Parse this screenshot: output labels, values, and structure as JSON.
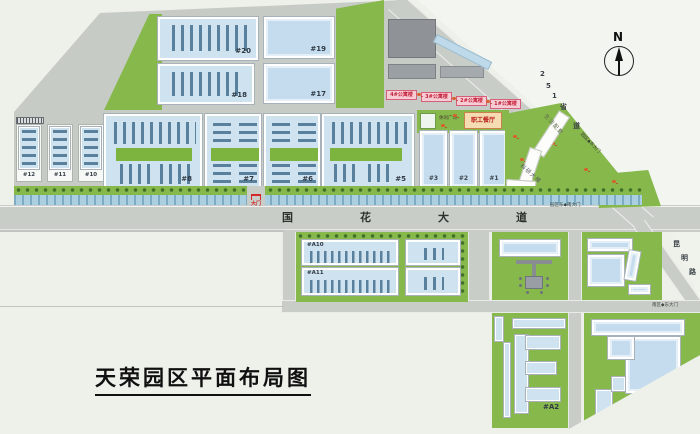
{
  "title": "天荣园区平面布局图",
  "compass": {
    "n": "N"
  },
  "labels": {
    "b1": "#1",
    "b2": "#2",
    "b3": "#3",
    "b5": "#5",
    "b6": "#6",
    "b7": "#7",
    "b8": "#8",
    "b10": "#10",
    "b11": "#11",
    "b12": "#12",
    "b17": "#17",
    "b18": "#18",
    "b19": "#19",
    "b20": "#20",
    "a1": "#A1",
    "a2": "#A2",
    "a10": "#A10",
    "a11": "#A11"
  },
  "apartments": [
    "4#公寓楼",
    "3#公寓楼",
    "2#公寓楼",
    "1#公寓楼"
  ],
  "facilities": {
    "canteen": "职工餐厅",
    "plaza": "休闲广场",
    "life_support": "生活配套",
    "research": "科研大楼"
  },
  "roads": {
    "guohua": [
      "国",
      "花",
      "大",
      "道"
    ],
    "s251": [
      "2",
      "5",
      "1",
      "省",
      "道"
    ],
    "kunming": [
      "昆",
      "明",
      "路"
    ]
  },
  "gates": {
    "east": "园区◆东大门",
    "south": "园区东◆南大门",
    "southeast": "南区◆东大门",
    "main": "大门"
  },
  "colors": {
    "green": "#87b84c",
    "water": "#a9cfe0",
    "building_fill": "#cfe2ef",
    "stripe": "#59809c",
    "road": "#c9cdc8",
    "apartment_pink": "#f8ccd4",
    "canteen_orange": "#f6dcb2",
    "accent_red": "#c61f3a"
  }
}
